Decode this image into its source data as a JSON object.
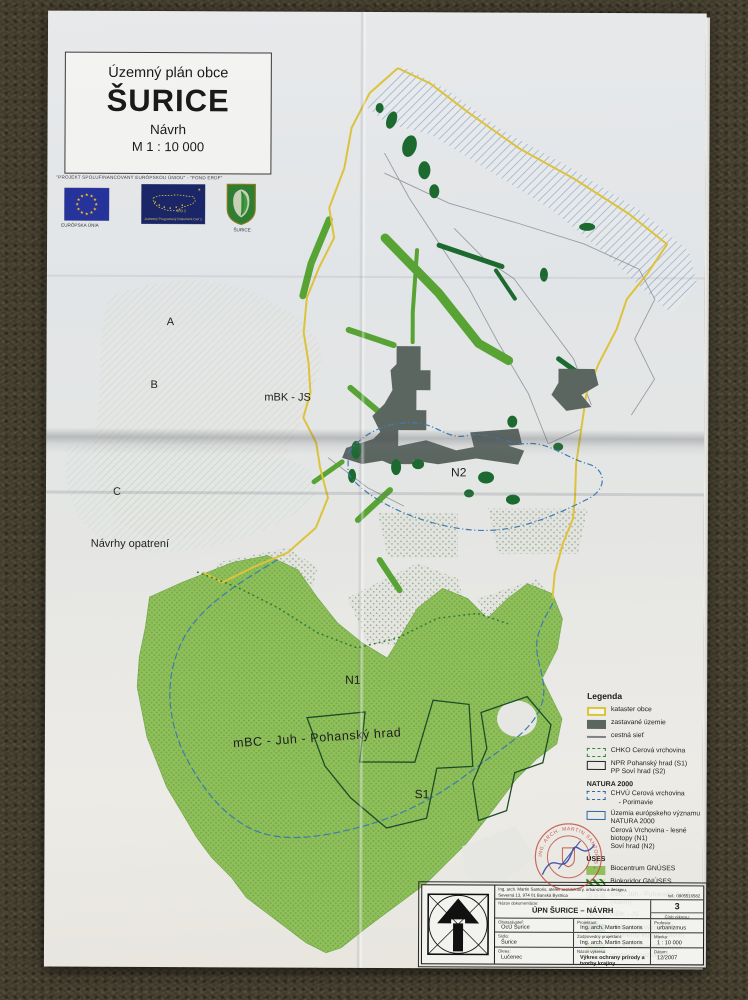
{
  "title_block": {
    "subtitle": "Územný plán obce",
    "title": "ŠURICE",
    "phase": "Návrh",
    "scale": "M 1 : 10 000"
  },
  "funding": {
    "header": "\"PROJEKT SPOLUFINANCOVANÝ EURÓPSKOU ÚNIOU\" - \"FOND ERDF\"",
    "eu_flag_label": "EURÓPSKA ÚNIA",
    "program_code": "JPD 2",
    "program_label": "Jednotný Programový Dokument Cieľ 2",
    "crest_label": "ŠURICE"
  },
  "map_labels": {
    "zone_a": "A",
    "zone_b": "B",
    "zone_c": "C",
    "mbk_js": "mBK - JS",
    "navrhy_opatreni": "Návrhy opatrení",
    "n2": "N2",
    "n1": "N1",
    "mbc_juh": "mBC - Juh - Pohanský hrad",
    "s1": "S1"
  },
  "legend": {
    "title": "Legenda",
    "natura_header": "NATURA 2000",
    "uses_header": "ÚSES",
    "items": [
      {
        "label": "kataster obce"
      },
      {
        "label": "zastavané územie"
      },
      {
        "label": "cestná sieť"
      },
      {
        "label": "CHKO Cerová vrchovina"
      },
      {
        "label": "NPR Pohanský hrad (S1)",
        "label2": "PP Soví hrad (S2)"
      },
      {
        "label": "CHVÚ Cerová vrchovina",
        "label2": "- Porimavie"
      },
      {
        "label": "Územia európskeho významu",
        "label2": "NATURA 2000",
        "label3": "Cerová Vrchovina - lesné biotopy (N1)",
        "label4": "Soví hrad (N2)"
      },
      {
        "label": "Biocentrum GNÚSES"
      },
      {
        "label": "Biokoridor GNÚSES"
      },
      {
        "label": "mBC Juh - Pohanský hrad (návrh)"
      },
      {
        "label": "mBK - JS"
      },
      {
        "label": "ekologicky významné",
        "label2": "segmenty krajiny (návrh)"
      },
      {
        "label": "návrh ekostabilizačných",
        "label2": "opatrení (zazelenenie)"
      }
    ]
  },
  "stamp": {
    "ring_text": "ING. ARCH. MARTIN SANTORIS •"
  },
  "titleblock": {
    "firm_line1": "Ing. arch. Martin Santoris, ateliér architektúry, urbanizmu a designu,",
    "firm_line2": "Severná 13, 974 01 Banská Bystrica",
    "firm_tel": "tel.: 0905516582",
    "doc_label": "Názov dokumentácie:",
    "doc_title": "ÚPN ŠURICE – NÁVRH",
    "sheet_no": "3",
    "sheet_no_label": "Číslo výkresu:",
    "client_label": "Obstarávateľ:",
    "client": "OcÚ Šurice",
    "designer_label": "Projektant:",
    "designer": "Ing. arch. Martin Santoris",
    "profession_label": "Profesia:",
    "profession": "urbanizmus",
    "seat_label": "Sídlo:",
    "seat": "Šurice",
    "responsible_label": "Zodpovedný projektant:",
    "responsible": "Ing. arch. Martin Santoris",
    "scale_label": "Mierka:",
    "scale": "1 : 10 000",
    "district_label": "Okres:",
    "district": "Lučenec",
    "drawing_label": "Názov výkresu:",
    "drawing": "Výkres ochrany prírody a tvorby krajiny",
    "date_label": "Dátum:",
    "date": "12/2007"
  }
}
